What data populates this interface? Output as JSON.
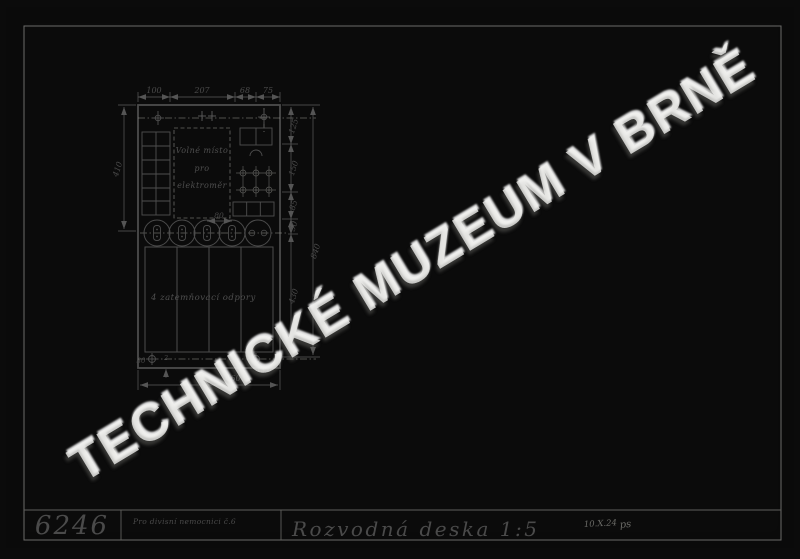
{
  "watermark": {
    "text": "TECHNICKÉ MUZEUM V BRNĚ"
  },
  "title_block": {
    "drawing_number": "6246",
    "project": "Pro divisní nemocnici č.6",
    "title": "Rozvodná deska 1:5",
    "date": "10.X.24",
    "signature": "ps"
  },
  "panel": {
    "meter_space_line1": "Volné místo",
    "meter_space_line2": "pro",
    "meter_space_line3": "elektroměr",
    "resistors_label": "4 zatemňovací odpory"
  },
  "dims": {
    "top_1": "100",
    "top_2": "207",
    "top_3": "68",
    "top_4": "75",
    "left_height": "410",
    "right_1": "125",
    "right_2": "150",
    "right_3": "85",
    "right_4": "50",
    "right_5": "430",
    "right_overall": "840",
    "bottom_overall": "460",
    "circle_pitch": "80",
    "hole_offset_left": "30",
    "hole_note": "2",
    "hole_offset_right": "13,6"
  }
}
